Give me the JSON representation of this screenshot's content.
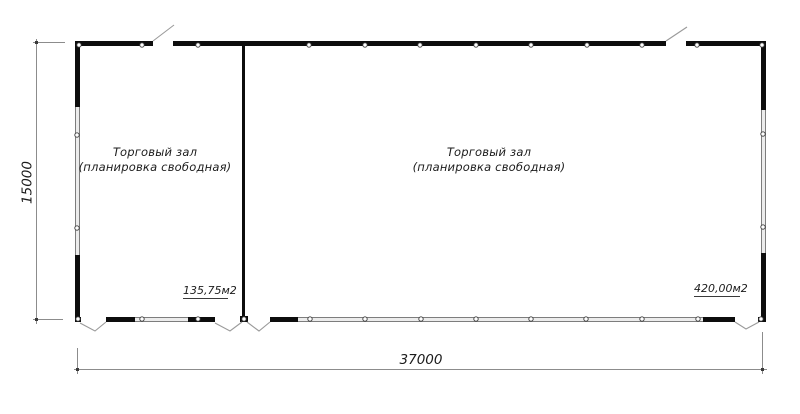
{
  "floor_plan": {
    "rooms": [
      {
        "label_line1": "Торговый зал",
        "label_line2": "(планировка свободная)",
        "area": "135,75м2"
      },
      {
        "label_line1": "Торговый зал",
        "label_line2": "(планировка свободная)",
        "area": "420,00м2"
      }
    ],
    "dimensions": {
      "overall_width": "37000",
      "overall_height": "15000"
    },
    "colors": {
      "wall": "#0d0d0d",
      "window": "#ececec",
      "dimension_line": "#8c8c8c",
      "text": "#1c1c1c",
      "background": "#ffffff"
    }
  }
}
